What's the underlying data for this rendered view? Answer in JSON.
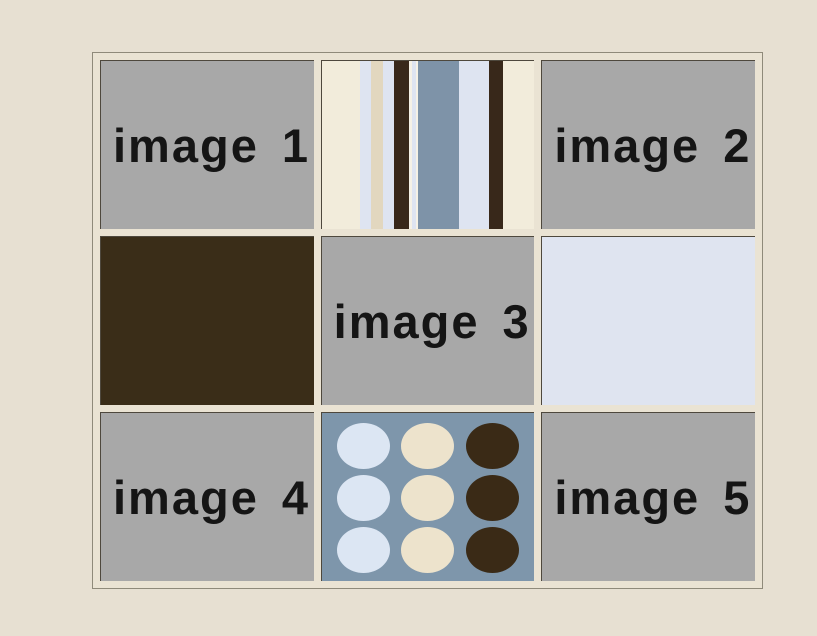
{
  "page": {
    "background": "#E7E0D2"
  },
  "frame": {
    "background": "#EAE3D3",
    "border_color": "#8F8A7A"
  },
  "text_color": "#151515",
  "cells": {
    "image1": {
      "label": "image 1",
      "background": "#A8A8A8"
    },
    "image2": {
      "label": "image 2",
      "background": "#A8A8A8"
    },
    "image3": {
      "label": "image 3",
      "background": "#A8A8A8"
    },
    "image4": {
      "label": "image 4",
      "background": "#A8A8A8"
    },
    "image5": {
      "label": "image 5",
      "background": "#A8A8A8"
    },
    "brown_swatch": {
      "background": "#3A2D18"
    },
    "pale_blue_swatch": {
      "background": "#DFE4F0"
    },
    "stripes": {
      "background": "#F2ECDB",
      "stripes": [
        {
          "color": "#F2ECDB",
          "width": 38
        },
        {
          "color": "#DEE4F1",
          "width": 11
        },
        {
          "color": "#E2D7BF",
          "width": 12
        },
        {
          "color": "#DEE4F1",
          "width": 10
        },
        {
          "color": "#38281A",
          "width": 15
        },
        {
          "color": "#F5F1E6",
          "width": 3
        },
        {
          "color": "#DEE4F1",
          "width": 4
        },
        {
          "color": "#F5F1E6",
          "width": 2
        },
        {
          "color": "#7E93A8",
          "width": 41
        },
        {
          "color": "#DEE4F1",
          "width": 29
        },
        {
          "color": "#38281A",
          "width": 14
        },
        {
          "color": "#F2ECDB",
          "width": 31
        }
      ]
    },
    "dots": {
      "background": "#7E96AB",
      "rows": 3,
      "dot_colors_by_column": [
        "#DCE6F3",
        "#EDE3CC",
        "#3A2A16"
      ]
    }
  }
}
